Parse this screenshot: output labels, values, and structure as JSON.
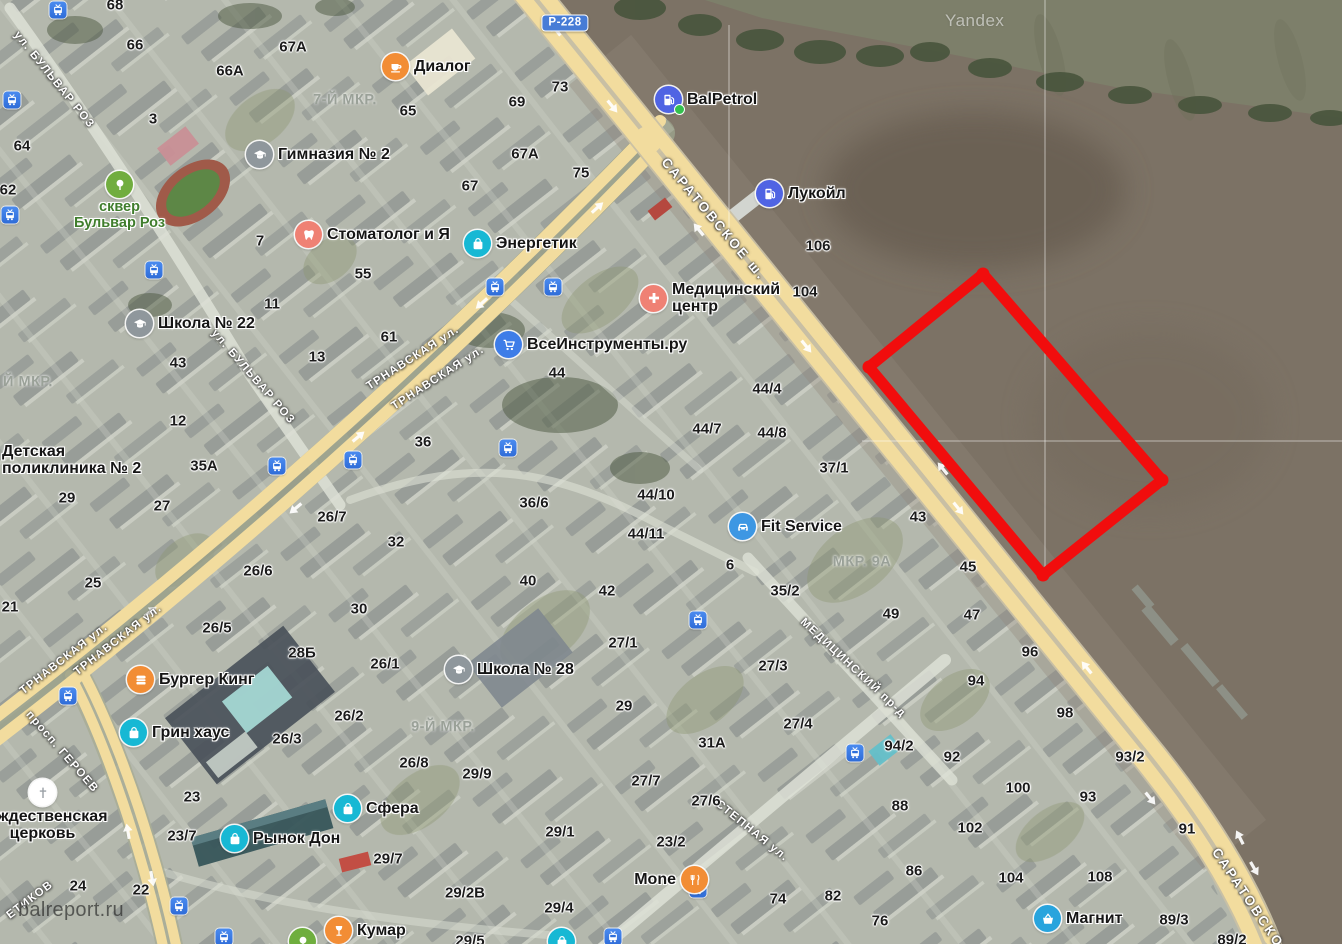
{
  "annotation": {
    "points": "983,274 1162,480 1043,575 869,367",
    "color": "#f10d0d"
  },
  "watermark": {
    "site": "balreport.ru",
    "brand": "Yandex"
  },
  "road_badge": {
    "text": "Р-228"
  },
  "streets": [
    {
      "t": "ул. БУЛЬВАР РОЗ",
      "x": 54,
      "y": 80,
      "r": 51
    },
    {
      "t": "ул. БУЛЬВАР РОЗ",
      "x": 253,
      "y": 377,
      "r": 49
    },
    {
      "t": "САРАТОВСКОЕ ш.",
      "x": 714,
      "y": 219,
      "r": 50,
      "s": 13.5,
      "sp": 2.5
    },
    {
      "t": "САРАТОВСКО",
      "x": 1248,
      "y": 898,
      "r": 56,
      "s": 13.5,
      "sp": 2.5
    },
    {
      "t": "ТРНАВСКАЯ ул.",
      "x": 413,
      "y": 358,
      "r": -33
    },
    {
      "t": "ТРНАВСКАЯ ул.",
      "x": 438,
      "y": 378,
      "r": -33
    },
    {
      "t": "ТРНАВСКАЯ ул.",
      "x": 118,
      "y": 640,
      "r": -38
    },
    {
      "t": "ТРНАВСКАЯ ул.",
      "x": 64,
      "y": 659,
      "r": -38
    },
    {
      "t": "просп. ГЕРОЕВ",
      "x": 62,
      "y": 752,
      "r": 49
    },
    {
      "t": "МЕДИЦИНСКИЙ пр-д",
      "x": 853,
      "y": 668,
      "r": 43
    },
    {
      "t": "СТЕПНАЯ ул.",
      "x": 752,
      "y": 831,
      "r": 39
    },
    {
      "t": "ЕТИКОВ",
      "x": 30,
      "y": 900,
      "r": -37
    }
  ],
  "areas": [
    {
      "t": "7-Й МКР.",
      "x": 345,
      "y": 100
    },
    {
      "t": "9-Й МКР.",
      "x": 443,
      "y": 727
    },
    {
      "t": "МКР. 9А",
      "x": 862,
      "y": 562
    },
    {
      "t": "Й МКР.",
      "x": 28,
      "y": 382
    }
  ],
  "numbers": [
    {
      "t": "68",
      "x": 115,
      "y": 5
    },
    {
      "t": "66",
      "x": 135,
      "y": 45
    },
    {
      "t": "67А",
      "x": 293,
      "y": 47
    },
    {
      "t": "66А",
      "x": 230,
      "y": 71
    },
    {
      "t": "65",
      "x": 408,
      "y": 111
    },
    {
      "t": "3",
      "x": 153,
      "y": 119
    },
    {
      "t": "64",
      "x": 22,
      "y": 146
    },
    {
      "t": "62",
      "x": 8,
      "y": 190
    },
    {
      "t": "73",
      "x": 560,
      "y": 87
    },
    {
      "t": "69",
      "x": 517,
      "y": 102
    },
    {
      "t": "67А",
      "x": 525,
      "y": 154
    },
    {
      "t": "75",
      "x": 581,
      "y": 173
    },
    {
      "t": "67",
      "x": 470,
      "y": 186
    },
    {
      "t": "7",
      "x": 260,
      "y": 241
    },
    {
      "t": "55",
      "x": 363,
      "y": 274
    },
    {
      "t": "11",
      "x": 272,
      "y": 304
    },
    {
      "t": "61",
      "x": 389,
      "y": 337
    },
    {
      "t": "13",
      "x": 317,
      "y": 357
    },
    {
      "t": "43",
      "x": 178,
      "y": 363
    },
    {
      "t": "12",
      "x": 178,
      "y": 421
    },
    {
      "t": "35А",
      "x": 204,
      "y": 466
    },
    {
      "t": "29",
      "x": 67,
      "y": 498
    },
    {
      "t": "27",
      "x": 162,
      "y": 506
    },
    {
      "t": "25",
      "x": 93,
      "y": 583
    },
    {
      "t": "21",
      "x": 10,
      "y": 607
    },
    {
      "t": "106",
      "x": 818,
      "y": 246
    },
    {
      "t": "104",
      "x": 805,
      "y": 292
    },
    {
      "t": "44",
      "x": 557,
      "y": 373
    },
    {
      "t": "44/4",
      "x": 767,
      "y": 389
    },
    {
      "t": "44/7",
      "x": 707,
      "y": 429
    },
    {
      "t": "44/8",
      "x": 772,
      "y": 433
    },
    {
      "t": "37/1",
      "x": 834,
      "y": 468
    },
    {
      "t": "44/10",
      "x": 656,
      "y": 495
    },
    {
      "t": "44/11",
      "x": 646,
      "y": 534
    },
    {
      "t": "36",
      "x": 423,
      "y": 442
    },
    {
      "t": "36/6",
      "x": 534,
      "y": 503
    },
    {
      "t": "26/7",
      "x": 332,
      "y": 517
    },
    {
      "t": "32",
      "x": 396,
      "y": 542
    },
    {
      "t": "40",
      "x": 528,
      "y": 581
    },
    {
      "t": "42",
      "x": 607,
      "y": 591
    },
    {
      "t": "30",
      "x": 359,
      "y": 609
    },
    {
      "t": "43",
      "x": 918,
      "y": 517
    },
    {
      "t": "45",
      "x": 968,
      "y": 567
    },
    {
      "t": "49",
      "x": 891,
      "y": 614
    },
    {
      "t": "47",
      "x": 972,
      "y": 615
    },
    {
      "t": "6",
      "x": 730,
      "y": 565
    },
    {
      "t": "35/2",
      "x": 785,
      "y": 591
    },
    {
      "t": "26/6",
      "x": 258,
      "y": 571
    },
    {
      "t": "26/5",
      "x": 217,
      "y": 628
    },
    {
      "t": "28Б",
      "x": 302,
      "y": 653
    },
    {
      "t": "26/1",
      "x": 385,
      "y": 664
    },
    {
      "t": "26/2",
      "x": 349,
      "y": 716
    },
    {
      "t": "26/3",
      "x": 287,
      "y": 739
    },
    {
      "t": "26/8",
      "x": 414,
      "y": 763
    },
    {
      "t": "29/9",
      "x": 477,
      "y": 774
    },
    {
      "t": "27/1",
      "x": 623,
      "y": 643
    },
    {
      "t": "29",
      "x": 624,
      "y": 706
    },
    {
      "t": "27/3",
      "x": 773,
      "y": 666
    },
    {
      "t": "31А",
      "x": 712,
      "y": 743
    },
    {
      "t": "27/4",
      "x": 798,
      "y": 724
    },
    {
      "t": "27/7",
      "x": 646,
      "y": 781
    },
    {
      "t": "27/6",
      "x": 706,
      "y": 801
    },
    {
      "t": "29/1",
      "x": 560,
      "y": 832
    },
    {
      "t": "23/2",
      "x": 671,
      "y": 842
    },
    {
      "t": "23",
      "x": 192,
      "y": 797
    },
    {
      "t": "23/7",
      "x": 182,
      "y": 836
    },
    {
      "t": "24",
      "x": 78,
      "y": 886
    },
    {
      "t": "22",
      "x": 141,
      "y": 890
    },
    {
      "t": "29/7",
      "x": 388,
      "y": 859
    },
    {
      "t": "29/2В",
      "x": 465,
      "y": 893
    },
    {
      "t": "29/4",
      "x": 559,
      "y": 908
    },
    {
      "t": "29/5",
      "x": 470,
      "y": 941
    },
    {
      "t": "74",
      "x": 778,
      "y": 899
    },
    {
      "t": "82",
      "x": 833,
      "y": 896
    },
    {
      "t": "86",
      "x": 914,
      "y": 871
    },
    {
      "t": "76",
      "x": 880,
      "y": 921
    },
    {
      "t": "96",
      "x": 1030,
      "y": 652
    },
    {
      "t": "94",
      "x": 976,
      "y": 681
    },
    {
      "t": "98",
      "x": 1065,
      "y": 713
    },
    {
      "t": "94/2",
      "x": 899,
      "y": 746
    },
    {
      "t": "92",
      "x": 952,
      "y": 757
    },
    {
      "t": "93/2",
      "x": 1130,
      "y": 757
    },
    {
      "t": "100",
      "x": 1018,
      "y": 788
    },
    {
      "t": "93",
      "x": 1088,
      "y": 797
    },
    {
      "t": "88",
      "x": 900,
      "y": 806
    },
    {
      "t": "102",
      "x": 970,
      "y": 828
    },
    {
      "t": "91",
      "x": 1187,
      "y": 829
    },
    {
      "t": "104",
      "x": 1011,
      "y": 878
    },
    {
      "t": "108",
      "x": 1100,
      "y": 877
    },
    {
      "t": "89/3",
      "x": 1174,
      "y": 920
    },
    {
      "t": "89/2",
      "x": 1232,
      "y": 940
    }
  ],
  "transit": [
    {
      "x": 58,
      "y": 10
    },
    {
      "x": 12,
      "y": 100
    },
    {
      "x": 10,
      "y": 215
    },
    {
      "x": 154,
      "y": 270
    },
    {
      "x": 495,
      "y": 287
    },
    {
      "x": 553,
      "y": 287
    },
    {
      "x": 353,
      "y": 460
    },
    {
      "x": 508,
      "y": 448
    },
    {
      "x": 277,
      "y": 466
    },
    {
      "x": 68,
      "y": 696
    },
    {
      "x": 698,
      "y": 620
    },
    {
      "x": 855,
      "y": 753
    },
    {
      "x": 698,
      "y": 889
    },
    {
      "x": 613,
      "y": 937
    },
    {
      "x": 179,
      "y": 906
    },
    {
      "x": 224,
      "y": 937
    }
  ],
  "pois": {
    "dialog": {
      "label": "Диалог"
    },
    "balpetrol": {
      "label": "BalPetrol"
    },
    "lukoil": {
      "label": "Лукойл"
    },
    "med": {
      "l1": "Медицинский",
      "l2": "центр"
    },
    "stomatolog": {
      "label": "Стоматолог и Я"
    },
    "energetik": {
      "label": "Энергетик"
    },
    "vse": {
      "label": "ВсеИнструменты.ру"
    },
    "fit": {
      "label": "Fit Service"
    },
    "gym2": {
      "label": "Гимназия № 2"
    },
    "school22": {
      "label": "Школа № 22"
    },
    "school28": {
      "label": "Школа № 28"
    },
    "park": {
      "l1": "сквер",
      "l2": "Бульвар Роз"
    },
    "burger": {
      "label": "Бургер Кинг"
    },
    "greenhouse": {
      "label": "Грин хаус"
    },
    "sfera": {
      "label": "Сфера"
    },
    "rynok": {
      "label": "Рынок Дон"
    },
    "mone": {
      "label": "Mone"
    },
    "kumar": {
      "label": "Кумар"
    },
    "magnit": {
      "label": "Магнит"
    },
    "church": {
      "l1": "Рождественская",
      "l2": "церковь"
    },
    "polyclinic": {
      "l1": "Детская",
      "l2": "поликлиника № 2"
    }
  }
}
